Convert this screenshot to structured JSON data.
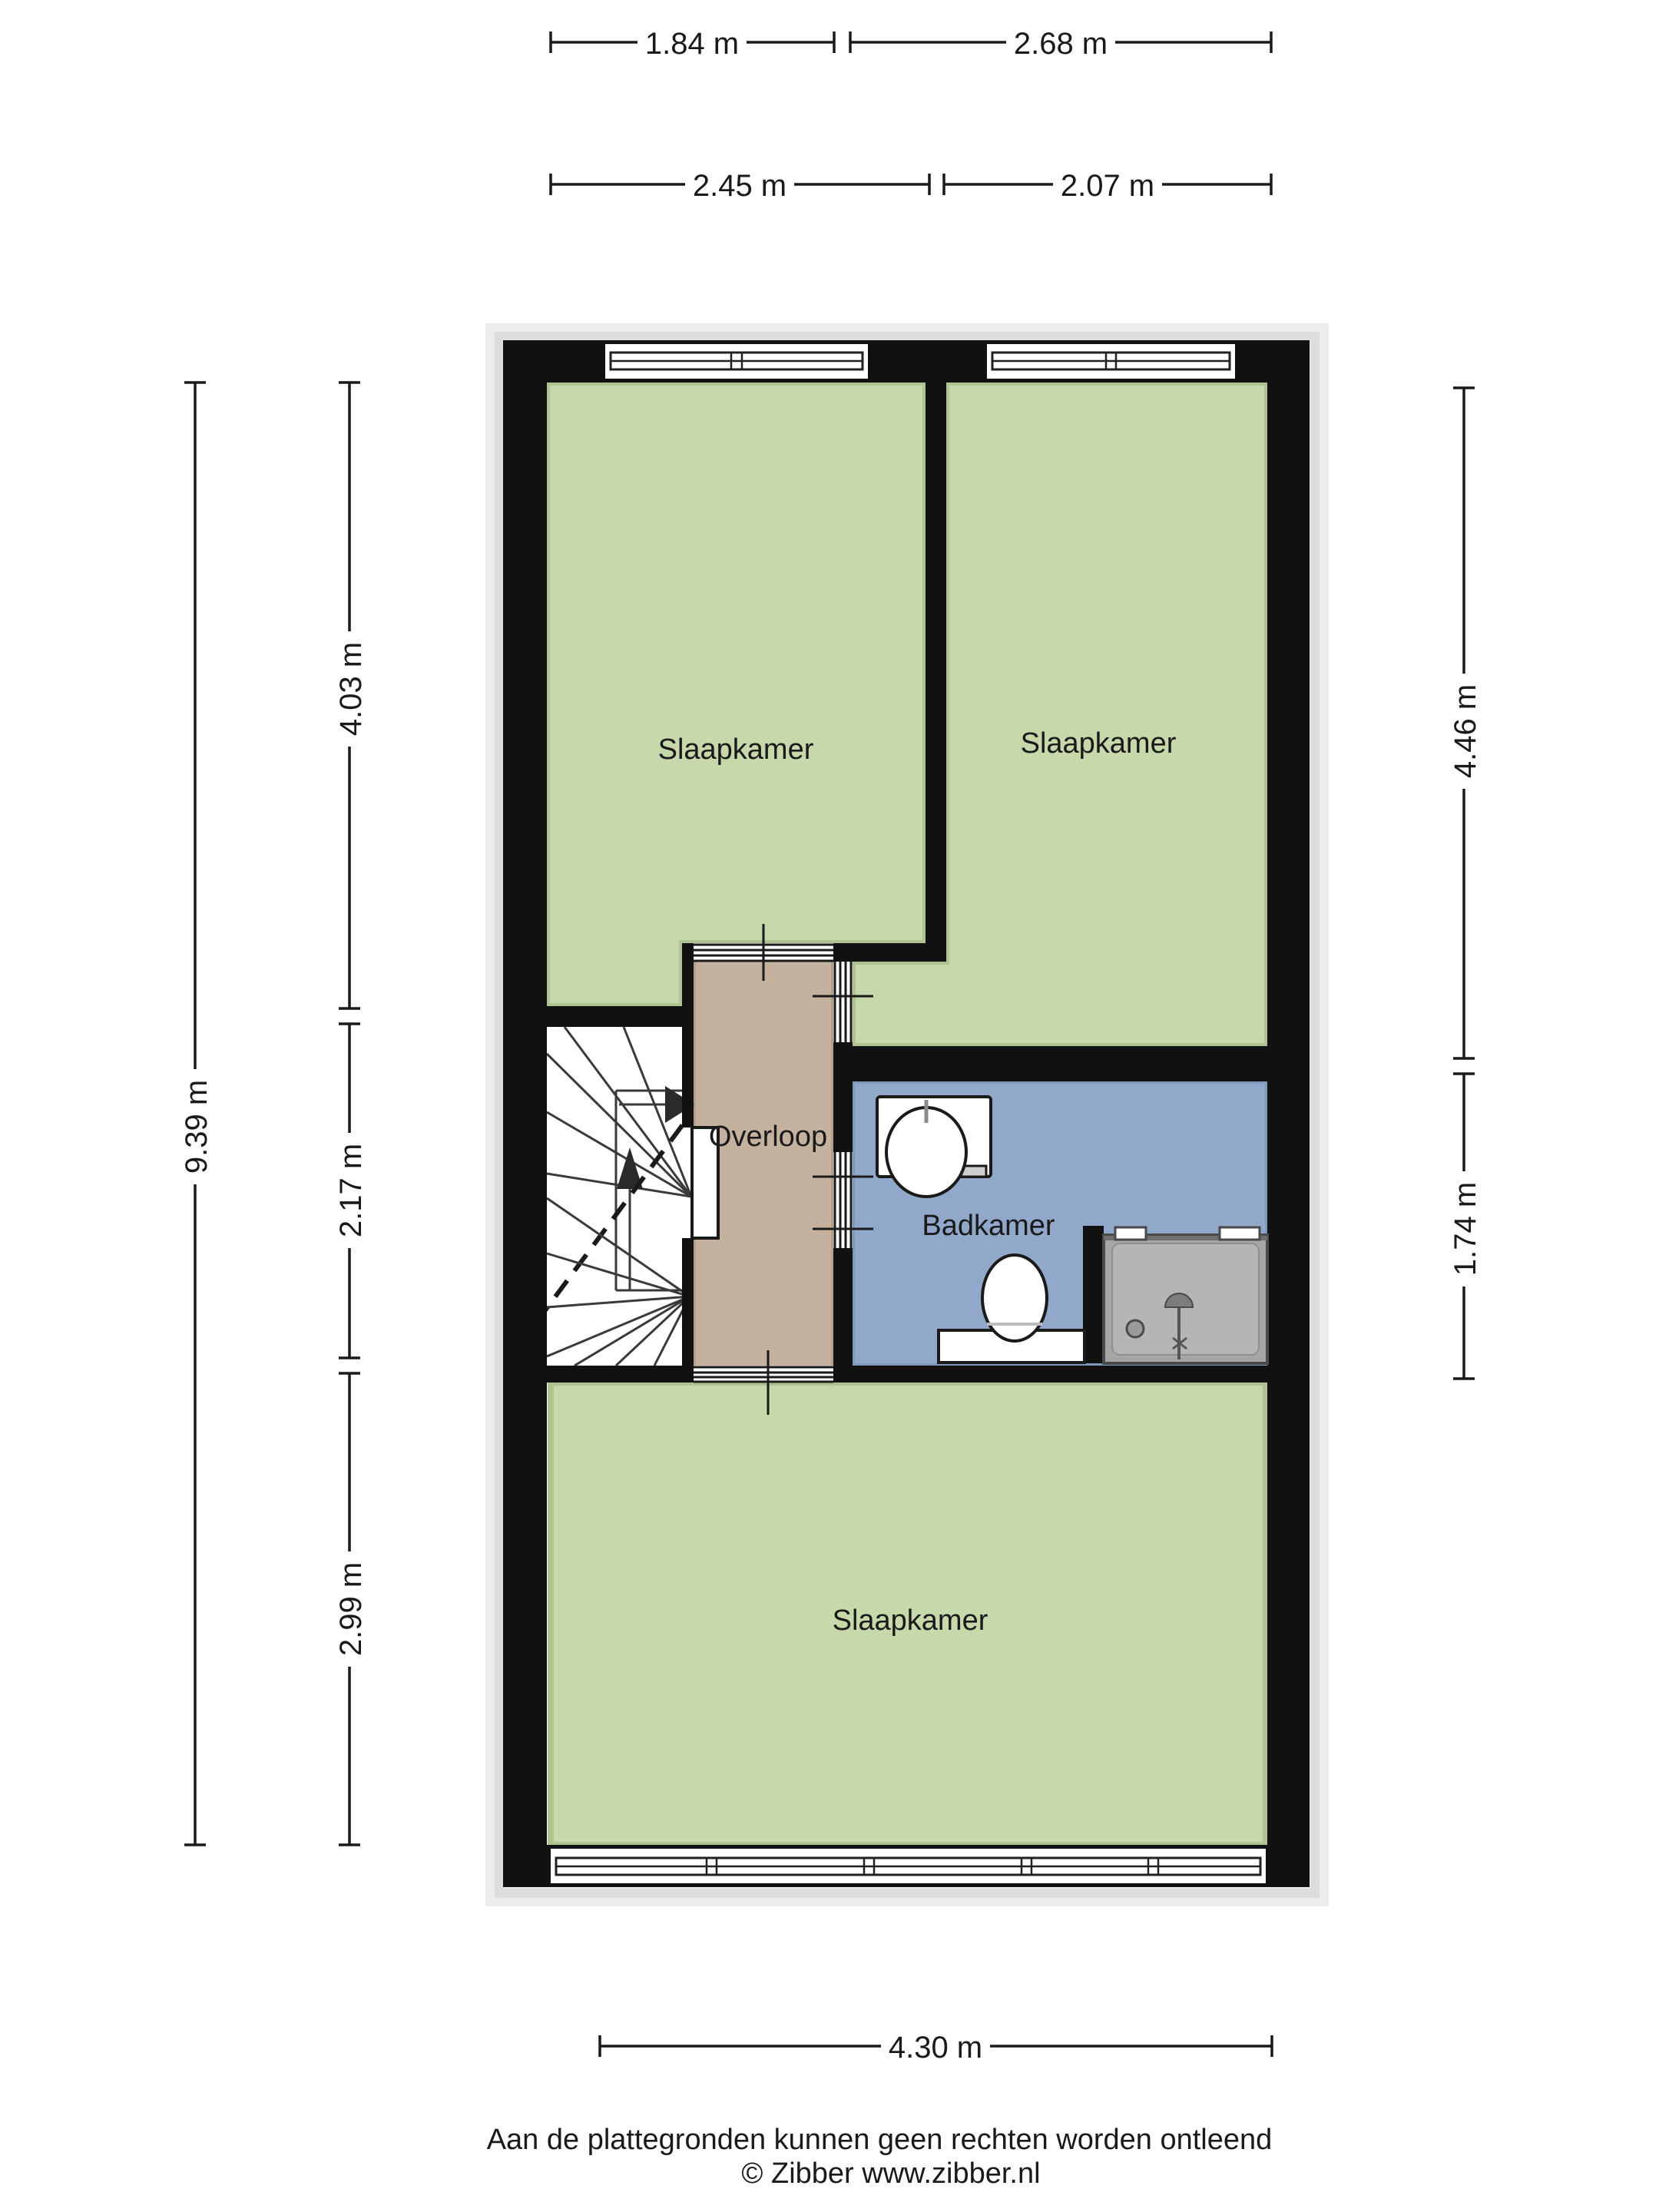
{
  "rooms": {
    "bedroom_top_left": "Slaapkamer",
    "bedroom_top_right": "Slaapkamer",
    "landing": "Overloop",
    "bathroom": "Badkamer",
    "bedroom_bottom": "Slaapkamer"
  },
  "dimensions": {
    "top_row1_left": "1.84 m",
    "top_row1_right": "2.68 m",
    "top_row2_left": "2.45 m",
    "top_row2_right": "2.07 m",
    "left_total": "9.39 m",
    "left_seg1": "4.03 m",
    "left_seg2": "2.17 m",
    "left_seg3": "2.99 m",
    "right_seg1": "4.46 m",
    "right_seg2": "1.74 m",
    "bottom": "4.30 m"
  },
  "footer": {
    "disclaimer": "Aan de plattegronden kunnen geen rechten worden ontleend",
    "copyright": "© Zibber www.zibber.nl"
  },
  "colors": {
    "room_floor": "#c7d9ab",
    "landing_floor": "#c4b29f",
    "bathroom_floor": "#92a8ca",
    "wall": "#111111",
    "shower_tray": "#a6a6a6"
  }
}
